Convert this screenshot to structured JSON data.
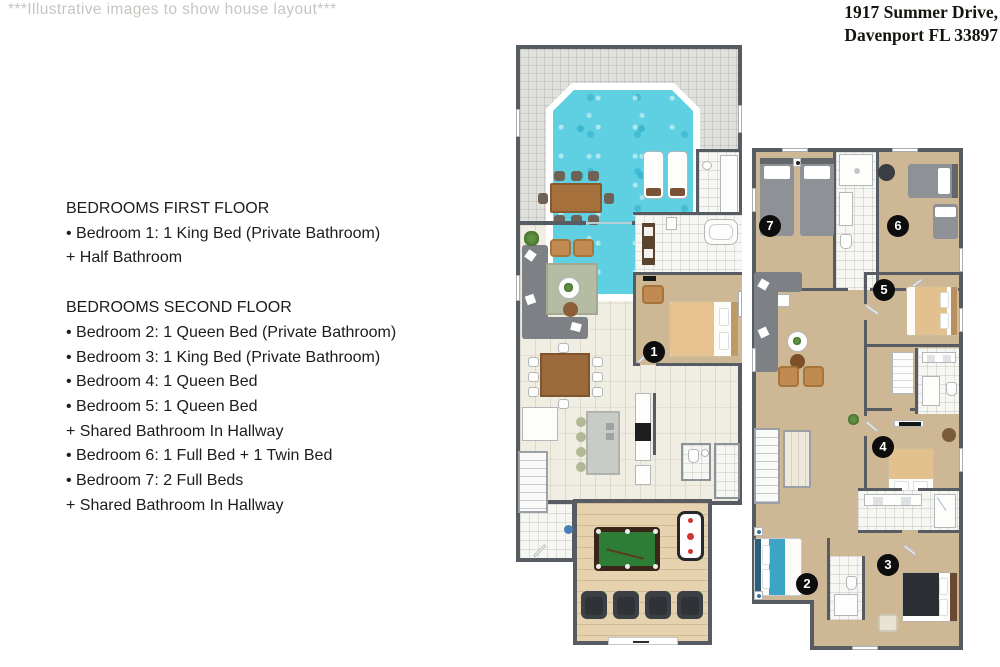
{
  "header": {
    "disclaimer": "***Illustrative images to show house layout***",
    "address_line1": "1917 Summer Drive,",
    "address_line2": "Davenport FL 33897"
  },
  "info": {
    "first_floor": {
      "title": "BEDROOMS FIRST FLOOR",
      "lines": [
        "• Bedroom 1: 1 King Bed (Private Bathroom)",
        "+ Half Bathroom"
      ]
    },
    "second_floor": {
      "title": "BEDROOMS SECOND FLOOR",
      "lines": [
        "• Bedroom 2: 1 Queen Bed (Private Bathroom)",
        "• Bedroom 3: 1 King Bed (Private Bathroom)",
        "• Bedroom 4: 1 Queen Bed",
        "• Bedroom 5: 1 Queen Bed",
        "+ Shared Bathroom In Hallway",
        "• Bedroom 6: 1 Full Bed + 1 Twin Bed",
        "• Bedroom 7: 2 Full Beds",
        "+ Shared Bathroom In Hallway"
      ]
    }
  },
  "markers": {
    "bedroom1": "1",
    "bedroom2": "2",
    "bedroom3": "3",
    "bedroom4": "4",
    "bedroom5": "5",
    "bedroom6": "6",
    "bedroom7": "7"
  },
  "colors": {
    "wall": "#575c63",
    "pool_water": "#5fd0e2",
    "carpet": "#cdb795",
    "hard_floor": "#f0ede2",
    "game_floor": "#e6d2ae",
    "bath_floor": "#f6f6f3",
    "armchair_tan": "#c08a52",
    "gray_bed": "#8e9297",
    "pool_table_felt": "#2e7d36",
    "bed2_teal": "#3ca4c6",
    "marker": "#0d0d0d"
  }
}
